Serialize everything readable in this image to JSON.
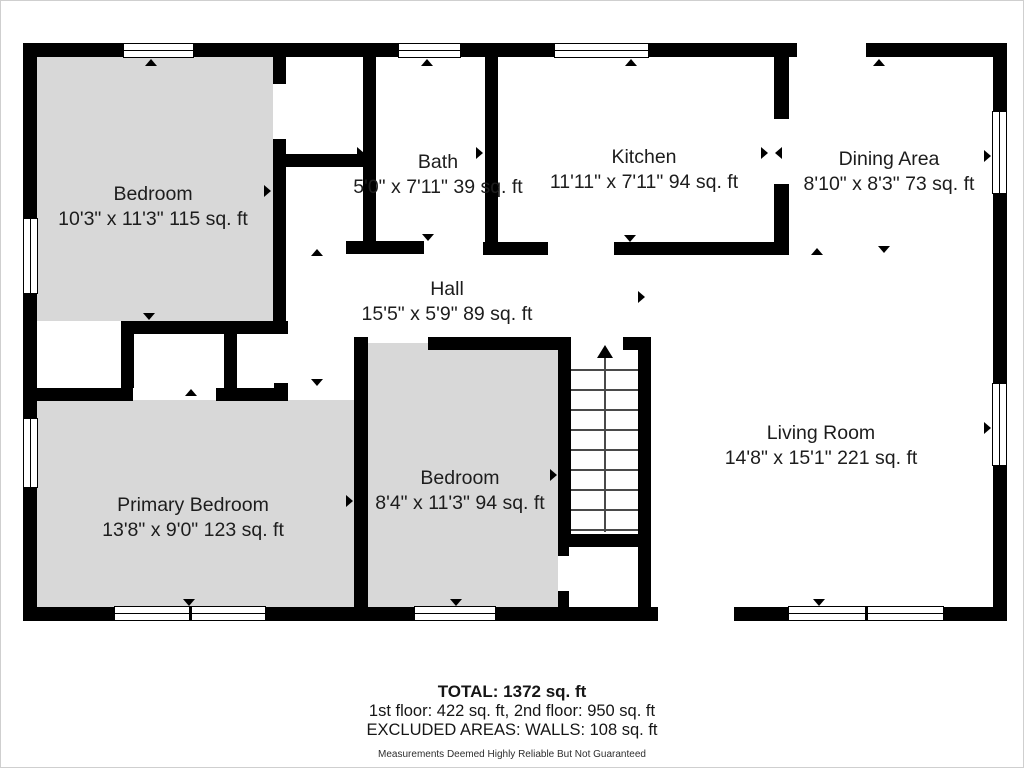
{
  "plan": {
    "rooms": [
      {
        "name": "Bedroom",
        "dims": "10'3\" x 11'3\" 115 sq. ft"
      },
      {
        "name": "Bath",
        "dims": "5'0\" x 7'11\" 39 sq. ft"
      },
      {
        "name": "Kitchen",
        "dims": "11'11\" x 7'11\" 94 sq. ft"
      },
      {
        "name": "Dining Area",
        "dims": "8'10\" x 8'3\" 73 sq. ft"
      },
      {
        "name": "Hall",
        "dims": "15'5\" x 5'9\" 89 sq. ft"
      },
      {
        "name": "Living Room",
        "dims": "14'8\" x 15'1\" 221 sq. ft"
      },
      {
        "name": "Primary Bedroom",
        "dims": "13'8\" x 9'0\" 123 sq. ft"
      },
      {
        "name": "Bedroom",
        "dims": "8'4\" x 11'3\" 94 sq. ft"
      }
    ],
    "colors": {
      "wall": "#000000",
      "bedroom_fill": "#d8d8d8",
      "text": "#1d1d1d"
    }
  },
  "footer": {
    "total": "TOTAL: 1372 sq. ft",
    "floors": "1st floor: 422 sq. ft, 2nd floor: 950 sq. ft",
    "excluded": "EXCLUDED AREAS: WALLS: 108 sq. ft",
    "disclaimer": "Measurements Deemed Highly Reliable But Not Guaranteed"
  }
}
